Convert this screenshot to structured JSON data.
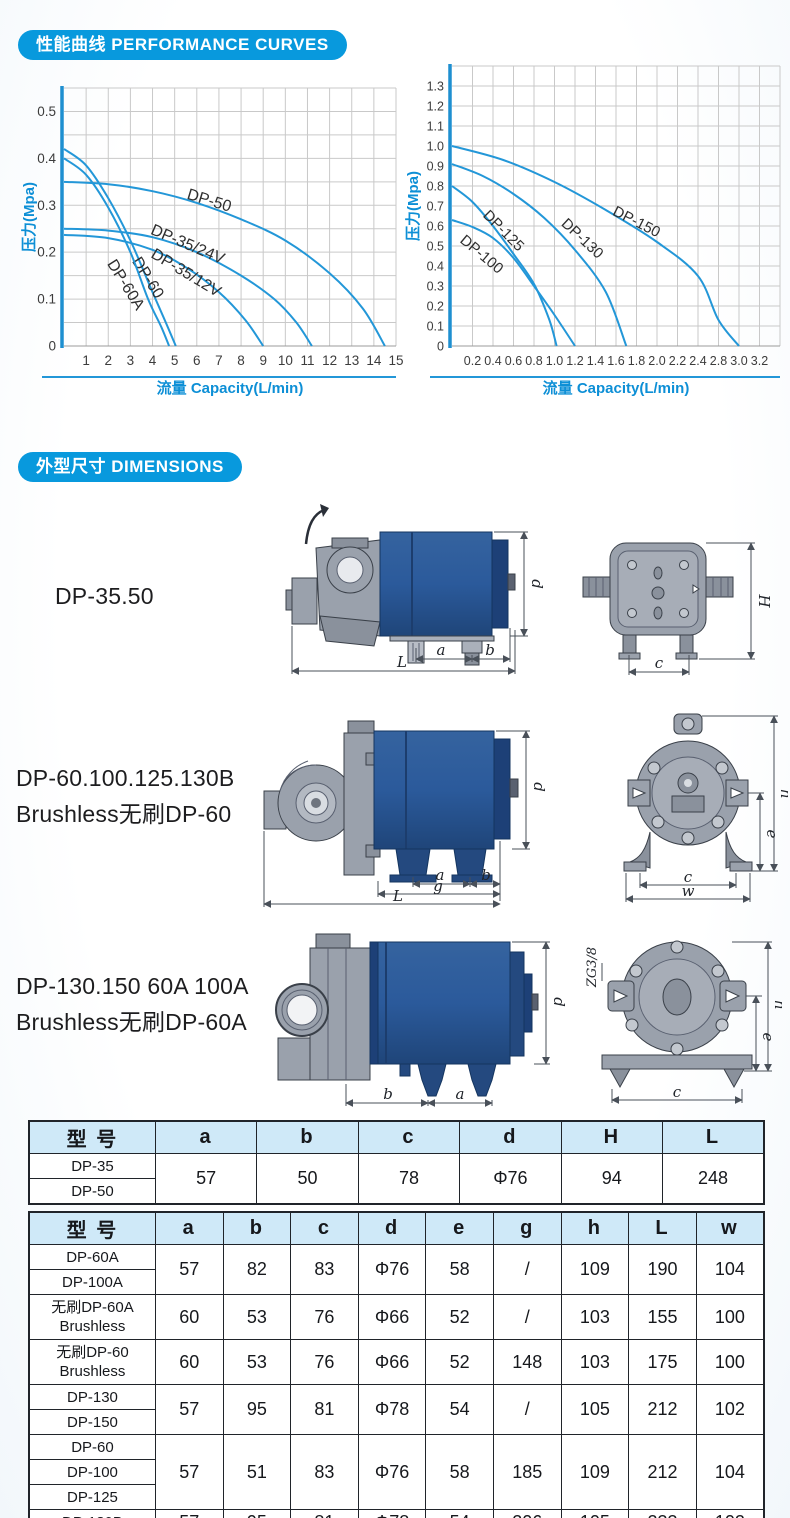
{
  "badges": {
    "curves": "性能曲线 PERFORMANCE CURVES",
    "dimensions": "外型尺寸 DIMENSIONS"
  },
  "colors": {
    "accent_blue": "#0899dd",
    "curve_blue": "#2397d8",
    "table_header_bg": "#cfe9f8",
    "pump_body_blue": "#2b5a9b",
    "pump_gray": "#9aa1ac"
  },
  "chart_data": [
    {
      "type": "line",
      "x_axis": {
        "title": "流量 Capacity(L/min)",
        "tick_values": [
          1,
          2,
          3,
          4,
          5,
          6,
          7,
          8,
          9,
          10,
          11,
          12,
          13,
          14,
          15
        ],
        "tick_labels": [
          "1",
          "2",
          "3",
          "4",
          "5",
          "6",
          "7",
          "8",
          "9",
          "10",
          "11",
          "12",
          "13",
          "14",
          "15"
        ]
      },
      "y_axis": {
        "title": "压力(Mpa)",
        "tick_labels": [
          "0",
          "0.1",
          "0.2",
          "0.3",
          "0.4",
          "0.5"
        ],
        "tick_step": 0.1,
        "grid_step": 0.05,
        "range": [
          0,
          0.55
        ]
      },
      "series": [
        {
          "name": "DP-50",
          "points": [
            [
              0,
              0.35
            ],
            [
              2,
              0.345
            ],
            [
              4,
              0.33
            ],
            [
              6,
              0.305
            ],
            [
              8,
              0.27
            ],
            [
              10,
              0.225
            ],
            [
              12,
              0.155
            ],
            [
              13.5,
              0.08
            ],
            [
              14.5,
              0
            ]
          ],
          "label_pos": [
            6.5,
            0.3
          ],
          "label_rot": 17
        },
        {
          "name": "DP-35/24V",
          "points": [
            [
              0,
              0.25
            ],
            [
              2,
              0.246
            ],
            [
              4,
              0.232
            ],
            [
              6,
              0.2
            ],
            [
              8,
              0.15
            ],
            [
              9.5,
              0.1
            ],
            [
              10.5,
              0.05
            ],
            [
              11.2,
              0
            ]
          ],
          "label_pos": [
            5.5,
            0.207
          ],
          "label_rot": 23
        },
        {
          "name": "DP-35/12V",
          "points": [
            [
              0,
              0.237
            ],
            [
              2,
              0.23
            ],
            [
              4,
              0.205
            ],
            [
              5.5,
              0.168
            ],
            [
              7,
              0.115
            ],
            [
              8.2,
              0.055
            ],
            [
              9,
              0
            ]
          ],
          "label_pos": [
            5.4,
            0.147
          ],
          "label_rot": 31
        },
        {
          "name": "DP-60",
          "points": [
            [
              0,
              0.42
            ],
            [
              1,
              0.385
            ],
            [
              2,
              0.315
            ],
            [
              3,
              0.225
            ],
            [
              4,
              0.115
            ],
            [
              4.6,
              0.05
            ],
            [
              5.05,
              0
            ]
          ],
          "label_pos": [
            3.6,
            0.14
          ],
          "label_rot": 58
        },
        {
          "name": "DP-60A",
          "points": [
            [
              0,
              0.4
            ],
            [
              1,
              0.365
            ],
            [
              2,
              0.295
            ],
            [
              3,
              0.2
            ],
            [
              3.8,
              0.1
            ],
            [
              4.4,
              0.04
            ],
            [
              4.75,
              0
            ]
          ],
          "label_pos": [
            2.6,
            0.125
          ],
          "label_rot": 58
        }
      ]
    },
    {
      "type": "line",
      "x_axis": {
        "title": "流量 Capacity(L/min)",
        "tick_values": [
          0.2,
          0.4,
          0.6,
          0.8,
          1.0,
          1.2,
          1.4,
          1.6,
          1.8,
          2.0,
          2.2,
          2.4,
          2.8,
          3.0,
          3.2
        ],
        "tick_labels": [
          "0.2",
          "0.4",
          "0.6",
          "0.8",
          "1.0",
          "1.2",
          "1.4",
          "1.6",
          "1.8",
          "2.0",
          "2.2",
          "2.4",
          "2.8",
          "3.0",
          "3.2"
        ]
      },
      "y_axis": {
        "title": "压力(Mpa)",
        "tick_labels": [
          "0",
          "0.1",
          "0.2",
          "0.3",
          "0.4",
          "0.5",
          "0.6",
          "0.7",
          "0.8",
          "0.9",
          "1.0",
          "1.1",
          "1.2",
          "1.3"
        ],
        "tick_step": 0.1,
        "grid_step": 0.1,
        "range": [
          0,
          1.4
        ]
      },
      "series": [
        {
          "name": "DP-150",
          "points": [
            [
              0,
              1.0
            ],
            [
              0.5,
              0.93
            ],
            [
              1.0,
              0.82
            ],
            [
              1.5,
              0.68
            ],
            [
              2.0,
              0.52
            ],
            [
              2.4,
              0.35
            ],
            [
              2.8,
              0.13
            ],
            [
              3.0,
              0
            ]
          ],
          "label_pos": [
            1.78,
            0.6
          ],
          "label_rot": 27
        },
        {
          "name": "DP-130",
          "points": [
            [
              0,
              0.91
            ],
            [
              0.3,
              0.85
            ],
            [
              0.6,
              0.76
            ],
            [
              0.9,
              0.64
            ],
            [
              1.2,
              0.48
            ],
            [
              1.5,
              0.27
            ],
            [
              1.7,
              0
            ]
          ],
          "label_pos": [
            1.24,
            0.52
          ],
          "label_rot": 43
        },
        {
          "name": "DP-125",
          "points": [
            [
              0,
              0.8
            ],
            [
              0.2,
              0.72
            ],
            [
              0.4,
              0.6
            ],
            [
              0.6,
              0.46
            ],
            [
              0.8,
              0.31
            ],
            [
              0.95,
              0.13
            ],
            [
              1.02,
              0
            ]
          ],
          "label_pos": [
            0.47,
            0.56
          ],
          "label_rot": 45
        },
        {
          "name": "DP-100",
          "points": [
            [
              0,
              0.63
            ],
            [
              0.2,
              0.595
            ],
            [
              0.4,
              0.54
            ],
            [
              0.6,
              0.44
            ],
            [
              0.8,
              0.3
            ],
            [
              1.0,
              0.155
            ],
            [
              1.2,
              0
            ]
          ],
          "label_pos": [
            0.26,
            0.44
          ],
          "label_rot": 40
        }
      ]
    }
  ],
  "drawings": [
    {
      "label_lines": [
        "DP-35.50"
      ],
      "dims": {
        "a": "a",
        "b": "b",
        "L": "L",
        "d": "d",
        "H": "H",
        "c": "c"
      }
    },
    {
      "label_lines": [
        "DP-60.100.125.130B",
        "Brushless无刷DP-60"
      ],
      "dims": {
        "a": "a",
        "b": "b",
        "g": "g",
        "L": "L",
        "d": "d",
        "h": "h",
        "e": "e",
        "c": "c",
        "w": "w"
      }
    },
    {
      "label_lines": [
        "DP-130.150 60A 100A",
        "Brushless无刷DP-60A"
      ],
      "thread_label": "ZG3/8",
      "dims": {
        "a": "a",
        "b": "b",
        "d": "d",
        "h": "h",
        "e": "e",
        "c": "c"
      }
    }
  ],
  "tables": [
    {
      "headers": [
        "型 号",
        "a",
        "b",
        "c",
        "d",
        "H",
        "L"
      ],
      "col_widths": [
        "17.2%",
        "13.8%",
        "13.8%",
        "13.8%",
        "13.8%",
        "13.8%",
        "13.8%"
      ],
      "row_groups": [
        {
          "model_lines": [
            "DP-35",
            "DP-50"
          ],
          "split": true,
          "values": [
            "57",
            "50",
            "78",
            "Φ76",
            "94",
            "248"
          ]
        }
      ]
    },
    {
      "headers": [
        "型 号",
        "a",
        "b",
        "c",
        "d",
        "e",
        "g",
        "h",
        "L",
        "w"
      ],
      "col_widths": [
        "17.2%",
        "9.2%",
        "9.2%",
        "9.2%",
        "9.2%",
        "9.2%",
        "9.2%",
        "9.2%",
        "9.2%",
        "9.2%"
      ],
      "row_groups": [
        {
          "model_lines": [
            "DP-60A",
            "DP-100A"
          ],
          "split": true,
          "values": [
            "57",
            "82",
            "83",
            "Φ76",
            "58",
            "/",
            "109",
            "190",
            "104"
          ]
        },
        {
          "model_lines": [
            "无刷DP-60A",
            "Brushless"
          ],
          "split": false,
          "values": [
            "60",
            "53",
            "76",
            "Φ66",
            "52",
            "/",
            "103",
            "155",
            "100"
          ]
        },
        {
          "model_lines": [
            "无刷DP-60",
            "Brushless"
          ],
          "split": false,
          "values": [
            "60",
            "53",
            "76",
            "Φ66",
            "52",
            "148",
            "103",
            "175",
            "100"
          ]
        },
        {
          "model_lines": [
            "DP-130",
            "DP-150"
          ],
          "split": true,
          "values": [
            "57",
            "95",
            "81",
            "Φ78",
            "54",
            "/",
            "105",
            "212",
            "102"
          ]
        },
        {
          "model_lines": [
            "DP-60",
            "DP-100",
            "DP-125"
          ],
          "split": true,
          "values": [
            "57",
            "51",
            "83",
            "Φ76",
            "58",
            "185",
            "109",
            "212",
            "104"
          ]
        },
        {
          "model_lines": [
            "DP-130B"
          ],
          "split": true,
          "values": [
            "57",
            "95",
            "81",
            "Φ78",
            "54",
            "206",
            "105",
            "233",
            "102"
          ]
        }
      ]
    }
  ]
}
